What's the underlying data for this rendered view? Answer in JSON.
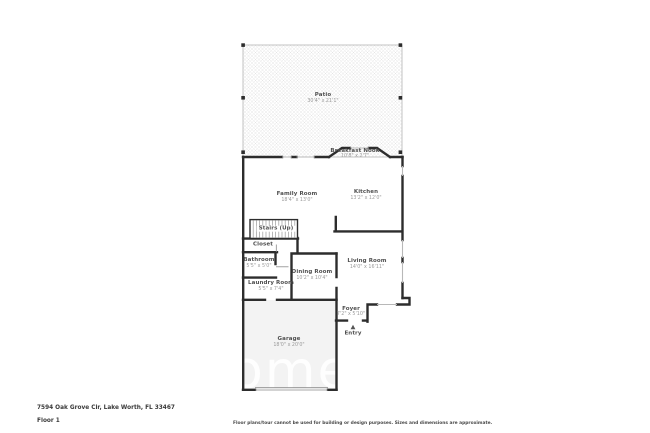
{
  "floorplan": {
    "title": "Floor plan",
    "watermark": "omes",
    "rooms": [
      {
        "name": "Patio",
        "dims": "30'4\" x 21'1\""
      },
      {
        "name": "Breakfast Nook",
        "dims": "10'8\" x 2'7\""
      },
      {
        "name": "Family Room",
        "dims": "18'4\" x 13'0\""
      },
      {
        "name": "Kitchen",
        "dims": "13'2\" x 12'0\""
      },
      {
        "name": "Stairs (Up)",
        "dims": ""
      },
      {
        "name": "Closet",
        "dims": ""
      },
      {
        "name": "Bathroom",
        "dims": "5'5\" x 5'0\""
      },
      {
        "name": "Dining Room",
        "dims": "10'2\" x 10'4\""
      },
      {
        "name": "Living Room",
        "dims": "14'0\" x 16'11\""
      },
      {
        "name": "Laundry Room",
        "dims": "5'5\" x 7'4\""
      },
      {
        "name": "Foyer",
        "dims": "7'2\" x 5'10\""
      },
      {
        "name": "Entry",
        "dims": ""
      },
      {
        "name": "Garage",
        "dims": "18'0\" x 20'0\""
      }
    ],
    "icons": {
      "entry_arrow": "triangle-up"
    },
    "colors": {
      "wall": "#2d2d2d",
      "window": "#b8b8b8",
      "garage_fill": "#f3f3f3",
      "patio_hatch": "#e4e4e4",
      "watermark": "#ffffff"
    }
  },
  "footer": {
    "address": "7594 Oak Grove Cir, Lake Worth, FL 33467",
    "floor_label": "Floor 1",
    "disclaimer": "Floor plans/tour cannot be used for building or design purposes. Sizes and dimensions are approximate."
  }
}
